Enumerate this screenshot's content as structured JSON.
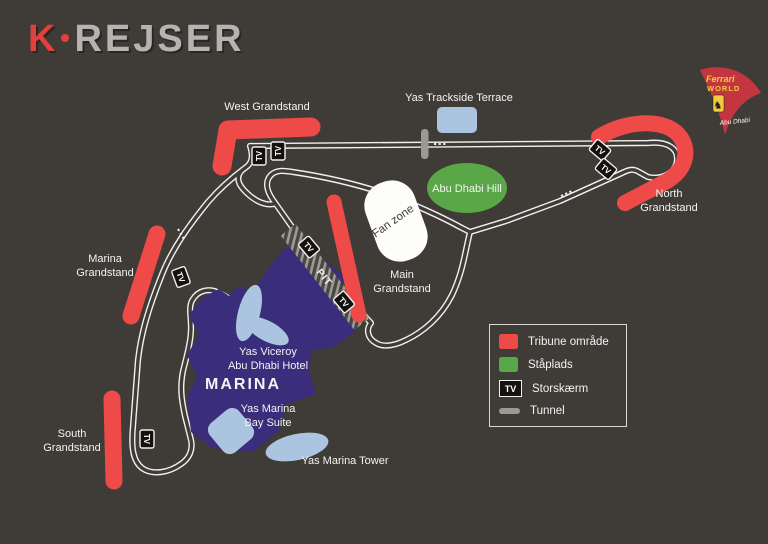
{
  "colors": {
    "background": "#3f3b37",
    "red": "#ee4b48",
    "green": "#5aa747",
    "light_blue": "#abc4e0",
    "purple": "#392d7c",
    "track": "#f1f0ee",
    "tunnel_gray": "#9c9995",
    "text": "#f4f3f1",
    "logo_gray": "#b7b3b0",
    "logo_red": "#e2403c",
    "ferrari_red": "#c33640",
    "ferrari_yellow": "#f2cb3d"
  },
  "logo": {
    "k": "K",
    "rest": "REJSER"
  },
  "ferrari_world": {
    "top": "Ferrari",
    "bottom": "WORLD",
    "script": "Abu Dhabi",
    "horse": "♞"
  },
  "labels": {
    "west_grandstand": "West Grandstand",
    "yas_trackside_terrace": "Yas Trackside Terrace",
    "abu_dhabi_hill": "Abu Dhabi Hill",
    "fan_zone": "Fan zone",
    "north_grandstand_1": "North",
    "north_grandstand_2": "Grandstand",
    "main_grandstand_1": "Main",
    "main_grandstand_2": "Grandstand",
    "marina_grandstand_1": "Marina",
    "marina_grandstand_2": "Grandstand",
    "south_grandstand_1": "South",
    "south_grandstand_2": "Grandstand",
    "pit": "PIT",
    "marina": "MARINA",
    "viceroy_1": "Yas Viceroy",
    "viceroy_2": "Abu Dhabi Hotel",
    "bay_suite_1": "Yas Marina",
    "bay_suite_2": "Bay Suite",
    "yas_marina_tower": "Yas Marina Tower",
    "tv": "TV"
  },
  "legend": {
    "items": [
      {
        "label": "Tribune område",
        "swatch": "red"
      },
      {
        "label": "Ståplads",
        "swatch": "green"
      },
      {
        "label": "Storskærm",
        "swatch": "tv"
      },
      {
        "label": "Tunnel",
        "swatch": "tunnel"
      }
    ]
  }
}
